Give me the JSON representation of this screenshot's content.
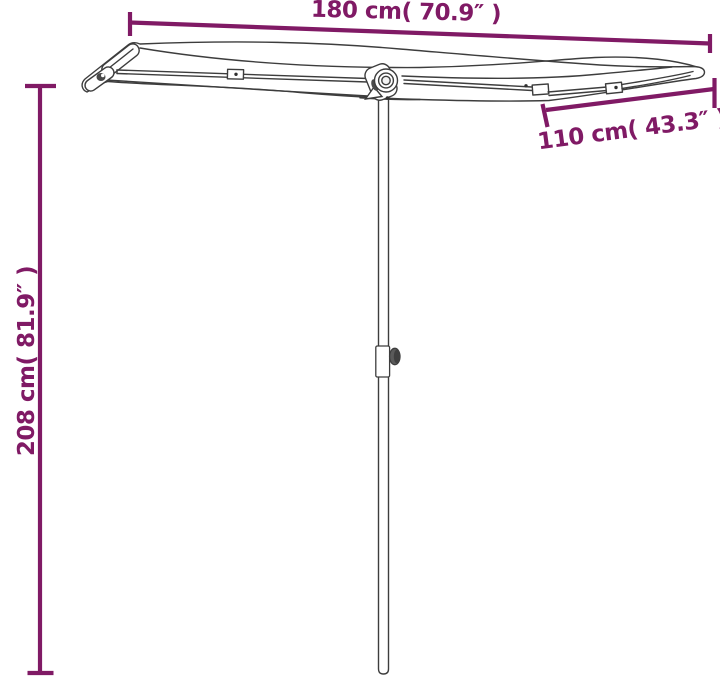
{
  "diagram": {
    "type": "product-dimension-diagram",
    "subject": "rectangular balcony parasol with aluminium pole",
    "accent_color": "#801a65",
    "line_color": "#3d3d3d",
    "background_color": "#ffffff",
    "labels": {
      "width": "180 cm( 70.9″ )",
      "depth": "110 cm( 43.3″ )",
      "height": "208 cm( 81.9″ )"
    }
  }
}
